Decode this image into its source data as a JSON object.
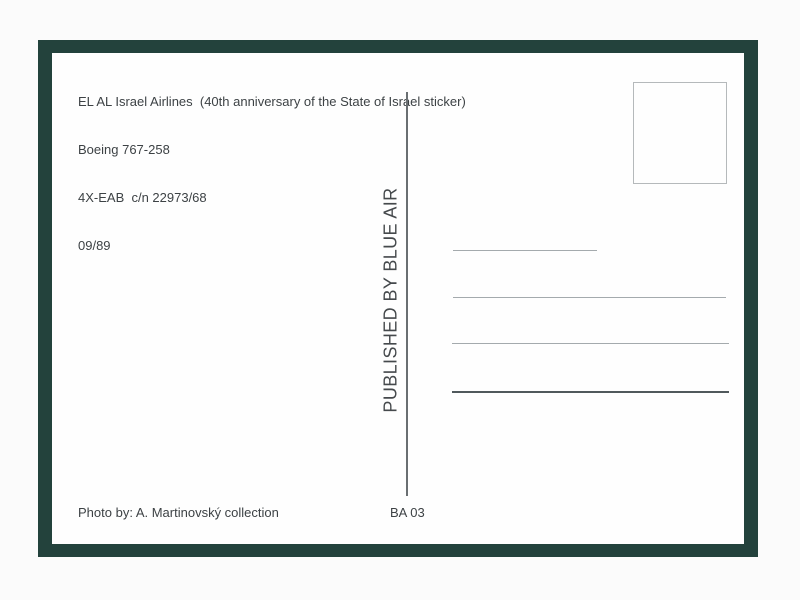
{
  "header": {
    "lines": [
      "EL AL Israel Airlines  (40th anniversary of the State of Israel sticker)",
      "Boeing 767-258",
      "4X-EAB  c/n 22973/68",
      "09/89"
    ]
  },
  "publisher": {
    "text": "PUBLISHED BY BLUE AIR"
  },
  "footer": {
    "photo_credit": "Photo by: A. Martinovský collection",
    "catalog_number": "BA 03"
  },
  "colors": {
    "page_background": "#fbfbfb",
    "frame": "#23423c",
    "card": "#fefefe",
    "text": "#3d4245",
    "publisher_text": "#45494c",
    "divider": "#6a6f72",
    "address_line_thin": "#a4aaad",
    "address_line_bottom": "#50595c",
    "stamp_border": "#b5b9bb"
  }
}
